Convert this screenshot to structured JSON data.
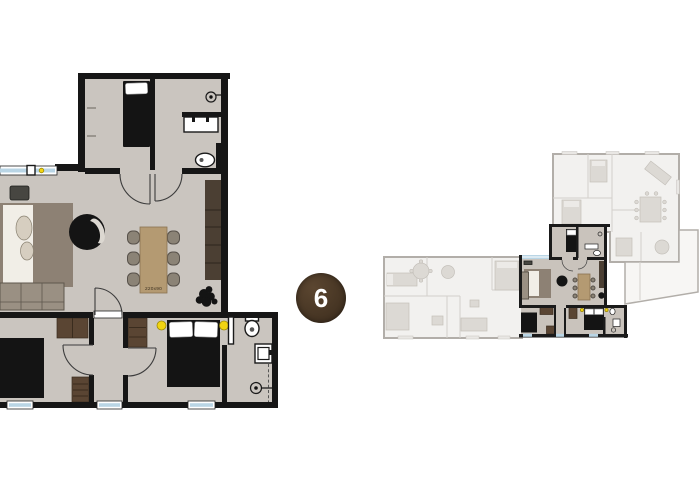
{
  "badge": {
    "label": "6"
  },
  "detail_plan": {
    "dining_table_label": "220x90"
  },
  "icons": {
    "bed": "black rectangle with white pillow",
    "sofa": "rectangle with seat lines",
    "armchair": "black circle with light cushion",
    "dining-table": "wood rectangle with six chairs",
    "toilet": "white ellipse",
    "sink": "white rectangle",
    "shower": "circle with center dot and line",
    "plant": "black organic blob",
    "tv": "dark rounded rectangle",
    "wardrobe": "dark wood rectangle",
    "door": "quarter-circle arc",
    "window": "light blue band",
    "lamp": "yellow circle"
  },
  "colors": {
    "bg": "#ffffff",
    "wall": "#161616",
    "floor": "#cac5bf",
    "window": "#b9d5e5",
    "window-frame": "#ffffff",
    "wood": "#5a4533",
    "wood-line": "#3a2c1e",
    "table": "#b49a72",
    "table-edge": "#8a7352",
    "rug": "#8d8174",
    "rug-light": "#f1eee7",
    "vase": "#d6cec0",
    "sofa": "#9a9083",
    "sofa-line": "#5e574d",
    "chair": "#8b8376",
    "chair-line": "#57514a",
    "feature-wall": "#4b3f33",
    "feature-line": "#2c251e",
    "black-furniture": "#141414",
    "fixture": "#ffffff",
    "fixture-line": "#1a1a1a",
    "lamp": "#f2d411",
    "lamp-edge": "#9c8a08",
    "tv": "#474641",
    "crescent": "#dcd8d1",
    "ov-wall": "#b2aea9",
    "ov-line": "#d3d0cb",
    "ov-floor": "#f2f1ef",
    "ov-furniture": "#dcd9d4",
    "ov-furniture-line": "#c4c0ba",
    "terrace": "#f7f6f4",
    "hl-floor": "#c9c3bc",
    "hl-wall": "#1a1a1a",
    "badge-bg-1": "#5b4630",
    "badge-bg-2": "#3a2b1c",
    "badge-text": "#ffffff"
  }
}
